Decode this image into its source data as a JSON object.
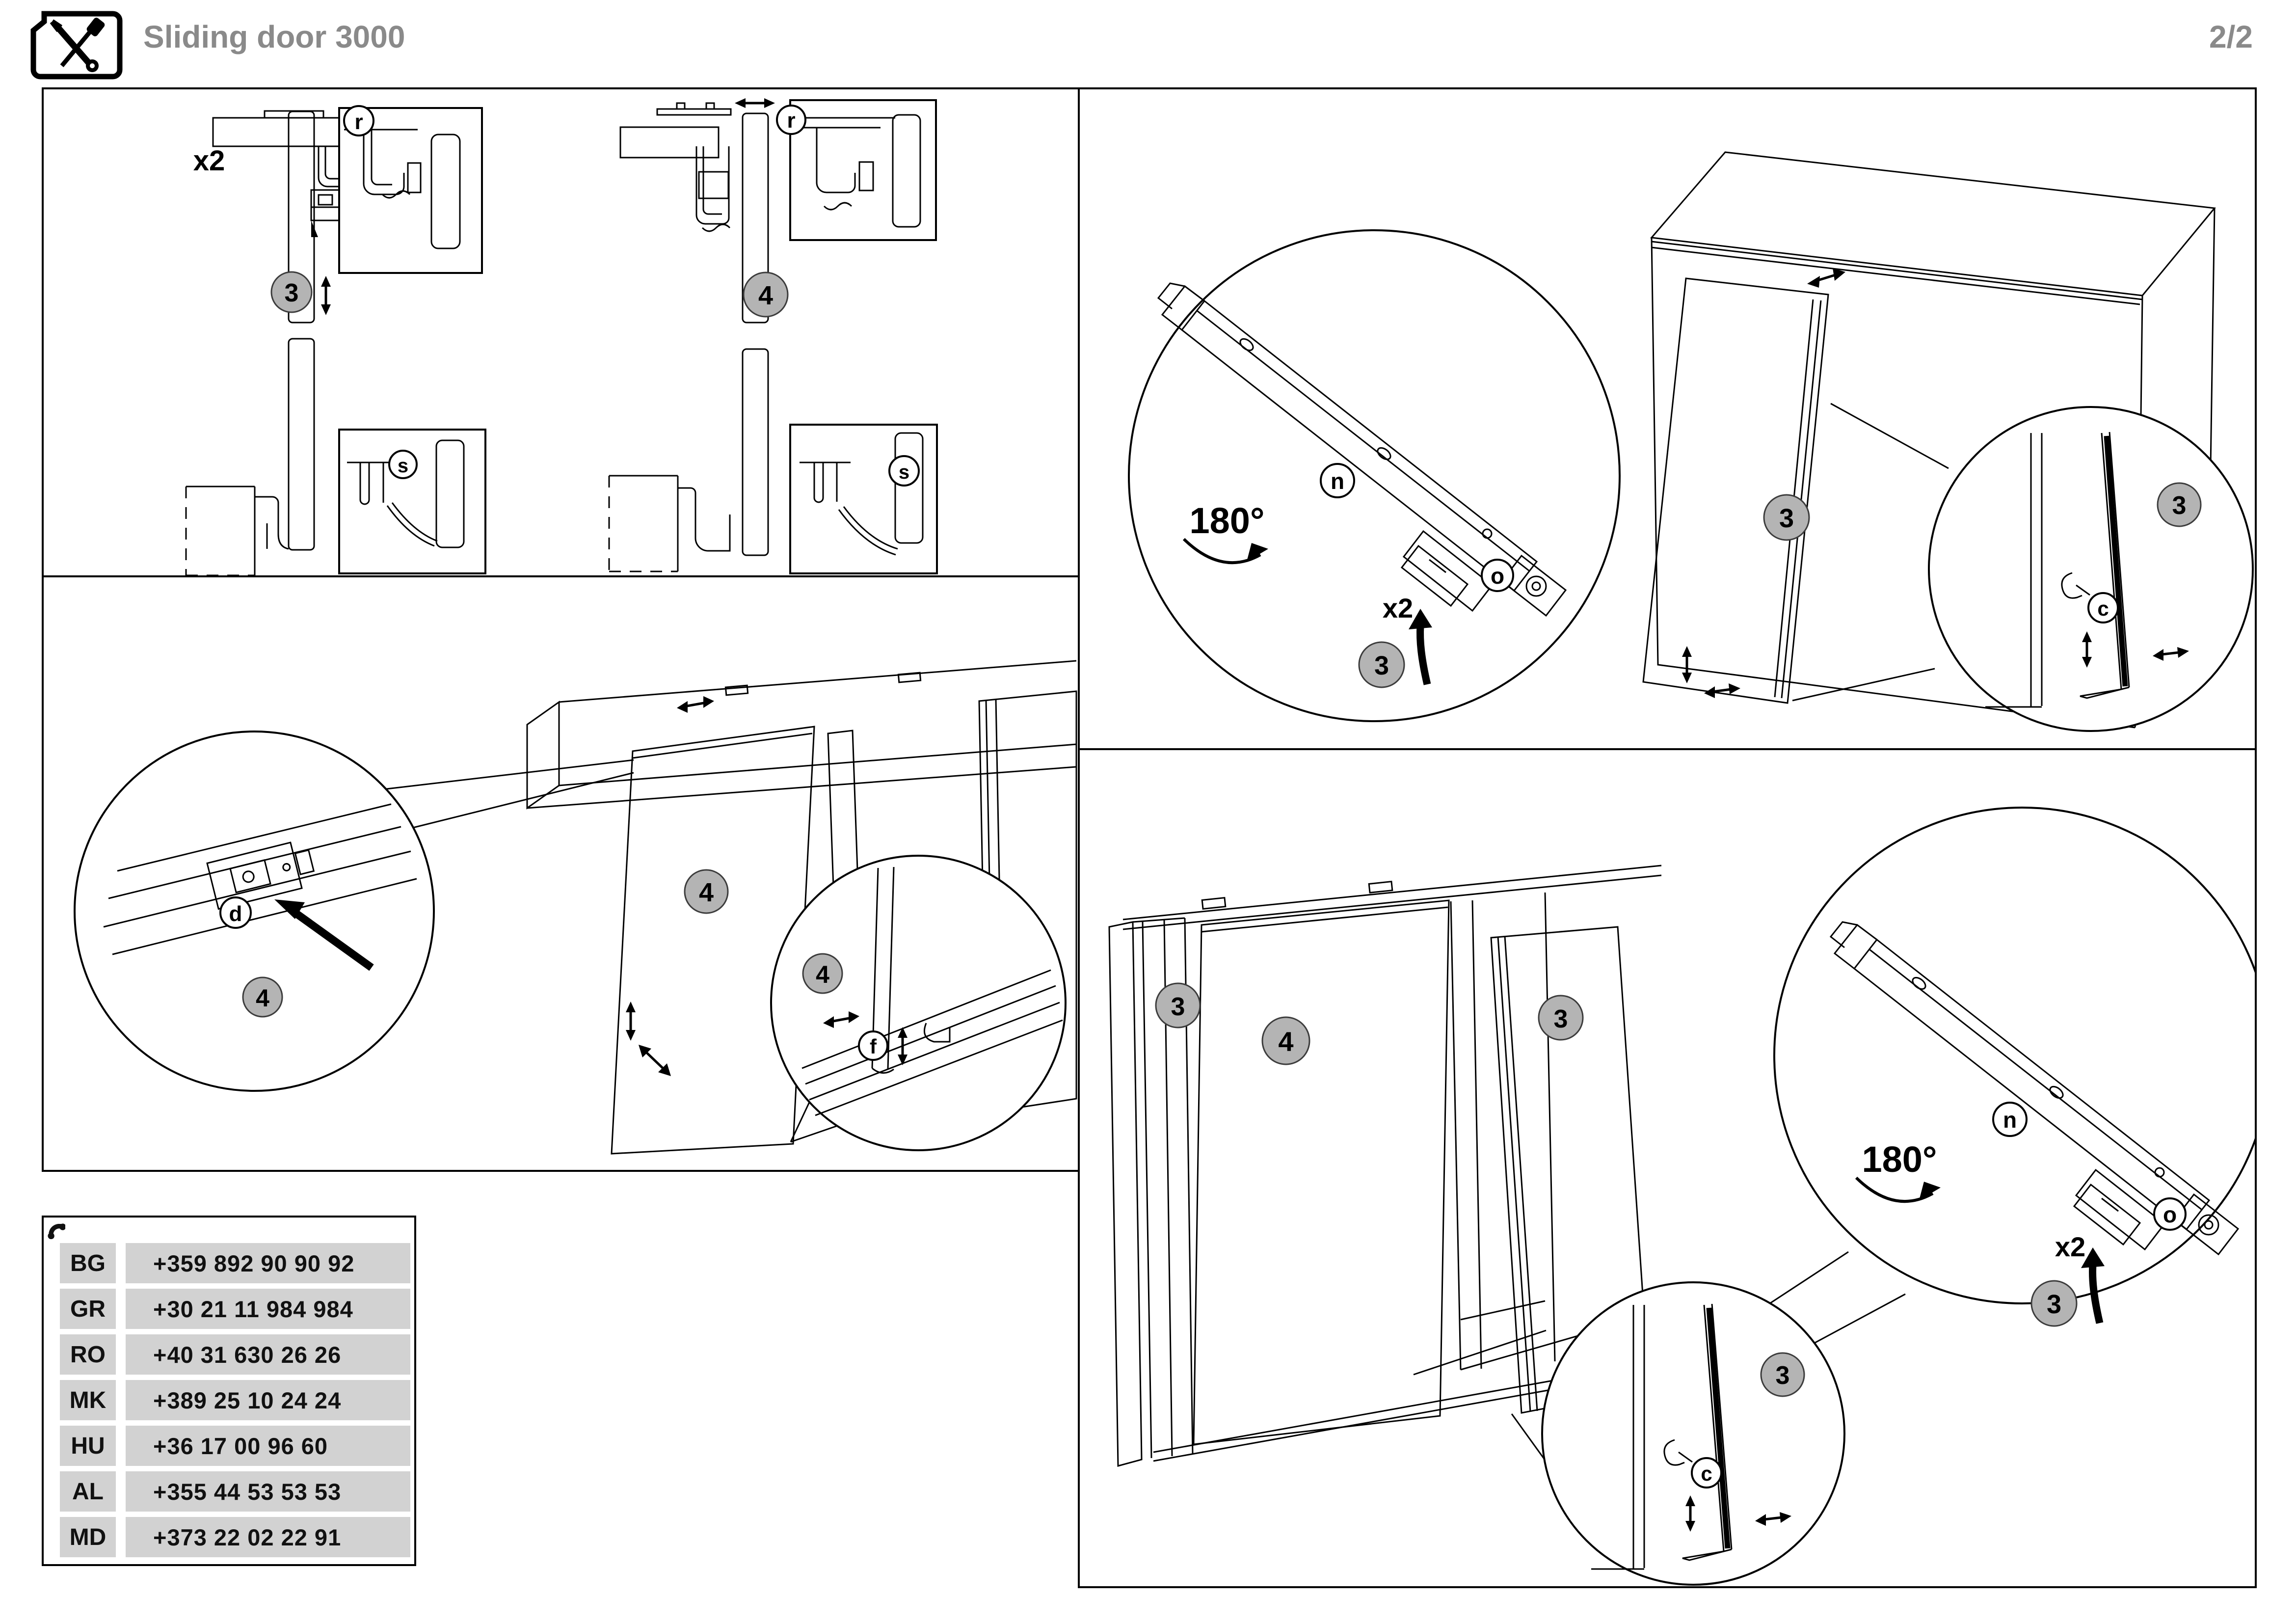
{
  "header": {
    "title": "Sliding door 3000",
    "page": "2/2"
  },
  "labels": {
    "multiplier": "x2",
    "rotation": "180°",
    "step3": "3",
    "step4": "4",
    "part_r": "r",
    "part_s": "s",
    "part_d": "d",
    "part_f": "f",
    "part_n": "n",
    "part_o": "o",
    "part_c": "c"
  },
  "support": {
    "rows": [
      {
        "country": "BG",
        "phone": "+359 892 90 90 92"
      },
      {
        "country": "GR",
        "phone": "+30 21 11 984 984"
      },
      {
        "country": "RO",
        "phone": "+40 31 630 26 26"
      },
      {
        "country": "MK",
        "phone": "+389 25 10 24 24"
      },
      {
        "country": "HU",
        "phone": "+36 17 00 96 60"
      },
      {
        "country": "AL",
        "phone": "+355 44 53 53 53"
      },
      {
        "country": "MD",
        "phone": "+373 22 02 22 91"
      }
    ]
  },
  "colors": {
    "title_gray": "#8a8a8a",
    "step_circle_fill": "#b4b4b4",
    "row_background": "#d2d2d2",
    "line_color": "#000000"
  }
}
